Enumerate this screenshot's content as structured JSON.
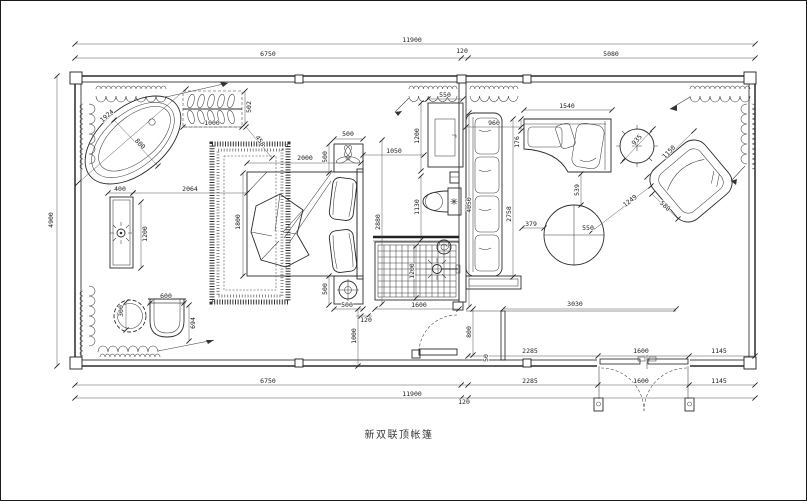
{
  "title": "新双联顶帐篷",
  "colors": {
    "ink": "#1c1c1c",
    "background": "#ffffff"
  },
  "plan": {
    "dim_labels": [
      {
        "t": "11900",
        "x": 412,
        "y": 40
      },
      {
        "t": "6750",
        "x": 268,
        "y": 54
      },
      {
        "t": "120",
        "x": 462,
        "y": 51
      },
      {
        "t": "5080",
        "x": 611,
        "y": 54
      },
      {
        "t": "4900",
        "x": 51,
        "y": 220,
        "r": -90
      },
      {
        "t": "2285",
        "x": 530,
        "y": 351
      },
      {
        "t": "1600",
        "x": 641,
        "y": 351
      },
      {
        "t": "1145",
        "x": 719,
        "y": 351
      },
      {
        "t": "6750",
        "x": 268,
        "y": 381
      },
      {
        "t": "2285",
        "x": 530,
        "y": 381
      },
      {
        "t": "1600",
        "x": 641,
        "y": 381
      },
      {
        "t": "1145",
        "x": 719,
        "y": 381
      },
      {
        "t": "11900",
        "x": 412,
        "y": 394
      },
      {
        "t": "120",
        "x": 464,
        "y": 402
      },
      {
        "t": "1924",
        "x": 107,
        "y": 116,
        "r": -41
      },
      {
        "t": "800",
        "x": 140,
        "y": 144,
        "r": 46
      },
      {
        "t": "1000",
        "x": 212,
        "y": 123
      },
      {
        "t": "502",
        "x": 249,
        "y": 107,
        "r": -90
      },
      {
        "t": "458",
        "x": 260,
        "y": 141,
        "r": 55
      },
      {
        "t": "400",
        "x": 120,
        "y": 189
      },
      {
        "t": "2064",
        "x": 190,
        "y": 189
      },
      {
        "t": "1200",
        "x": 145,
        "y": 234,
        "r": -90
      },
      {
        "t": "300",
        "x": 121,
        "y": 311,
        "r": -90
      },
      {
        "t": "600",
        "x": 166,
        "y": 296
      },
      {
        "t": "694",
        "x": 193,
        "y": 323,
        "r": -90
      },
      {
        "t": "2000",
        "x": 305,
        "y": 158
      },
      {
        "t": "500",
        "x": 348,
        "y": 134
      },
      {
        "t": "500",
        "x": 325,
        "y": 157,
        "r": -90
      },
      {
        "t": "1800",
        "x": 238,
        "y": 222,
        "r": -90
      },
      {
        "t": "500",
        "x": 325,
        "y": 289,
        "r": -90
      },
      {
        "t": "500",
        "x": 347,
        "y": 305
      },
      {
        "t": "120",
        "x": 366,
        "y": 320
      },
      {
        "t": "1000",
        "x": 354,
        "y": 336,
        "r": -90
      },
      {
        "t": "1050",
        "x": 394,
        "y": 151
      },
      {
        "t": "2880",
        "x": 378,
        "y": 222,
        "r": -90
      },
      {
        "t": "550",
        "x": 445,
        "y": 95
      },
      {
        "t": "1200",
        "x": 417,
        "y": 136,
        "r": -90
      },
      {
        "t": "1130",
        "x": 417,
        "y": 207,
        "r": -90
      },
      {
        "t": "1200",
        "x": 412,
        "y": 271,
        "r": -90
      },
      {
        "t": "1600",
        "x": 419,
        "y": 305
      },
      {
        "t": "800",
        "x": 469,
        "y": 332,
        "r": -90
      },
      {
        "t": "50",
        "x": 486,
        "y": 358,
        "r": -90
      },
      {
        "t": "4050",
        "x": 469,
        "y": 205,
        "r": -90
      },
      {
        "t": "960",
        "x": 494,
        "y": 123
      },
      {
        "t": "176",
        "x": 517,
        "y": 142,
        "r": -90
      },
      {
        "t": "1540",
        "x": 567,
        "y": 106
      },
      {
        "t": "2758",
        "x": 509,
        "y": 214,
        "r": -90
      },
      {
        "t": "539",
        "x": 577,
        "y": 190,
        "r": -90
      },
      {
        "t": "379",
        "x": 531,
        "y": 224
      },
      {
        "t": "550",
        "x": 588,
        "y": 228
      },
      {
        "t": "935",
        "x": 637,
        "y": 140,
        "r": -48
      },
      {
        "t": "1150",
        "x": 669,
        "y": 152,
        "r": -46
      },
      {
        "t": "1249",
        "x": 630,
        "y": 201,
        "r": -37
      },
      {
        "t": "580",
        "x": 665,
        "y": 206,
        "r": 44
      },
      {
        "t": "3030",
        "x": 575,
        "y": 304
      }
    ],
    "dim_lines": [
      {
        "x1": 75,
        "y1": 44,
        "x2": 755,
        "y2": 44
      },
      {
        "x1": 75,
        "y1": 58,
        "x2": 755,
        "y2": 58,
        "k": [
          0,
          0.568,
          0.578,
          1
        ]
      },
      {
        "x1": 57,
        "y1": 76,
        "x2": 57,
        "y2": 366
      },
      {
        "x1": 75,
        "y1": 385,
        "x2": 755,
        "y2": 385,
        "k": [
          0,
          0.568,
          0.578,
          0.769,
          0.903,
          1
        ]
      },
      {
        "x1": 75,
        "y1": 398,
        "x2": 755,
        "y2": 398,
        "k": [
          0,
          0.568,
          0.578,
          1
        ]
      },
      {
        "x1": 468,
        "y1": 356,
        "x2": 755,
        "y2": 356,
        "k": [
          0,
          0.453,
          0.77,
          1
        ]
      },
      {
        "x1": 183,
        "y1": 127,
        "x2": 242,
        "y2": 127
      },
      {
        "x1": 245,
        "y1": 91,
        "x2": 245,
        "y2": 124
      },
      {
        "x1": 108,
        "y1": 193,
        "x2": 133,
        "y2": 193
      },
      {
        "x1": 133,
        "y1": 193,
        "x2": 247,
        "y2": 193
      },
      {
        "x1": 141,
        "y1": 202,
        "x2": 141,
        "y2": 268
      },
      {
        "x1": 126,
        "y1": 302,
        "x2": 126,
        "y2": 330
      },
      {
        "x1": 150,
        "y1": 303,
        "x2": 184,
        "y2": 303
      },
      {
        "x1": 189,
        "y1": 305,
        "x2": 189,
        "y2": 341
      },
      {
        "x1": 247,
        "y1": 163,
        "x2": 361,
        "y2": 163
      },
      {
        "x1": 334,
        "y1": 139,
        "x2": 363,
        "y2": 139
      },
      {
        "x1": 329,
        "y1": 144,
        "x2": 329,
        "y2": 173
      },
      {
        "x1": 243,
        "y1": 173,
        "x2": 243,
        "y2": 276
      },
      {
        "x1": 329,
        "y1": 276,
        "x2": 329,
        "y2": 305
      },
      {
        "x1": 334,
        "y1": 309,
        "x2": 363,
        "y2": 309
      },
      {
        "x1": 356,
        "y1": 316,
        "x2": 372,
        "y2": 316,
        "k": [
          0.31,
          0.75
        ]
      },
      {
        "x1": 358,
        "y1": 309,
        "x2": 358,
        "y2": 366
      },
      {
        "x1": 363,
        "y1": 155,
        "x2": 424,
        "y2": 155
      },
      {
        "x1": 382,
        "y1": 140,
        "x2": 382,
        "y2": 304
      },
      {
        "x1": 428,
        "y1": 99,
        "x2": 463,
        "y2": 99
      },
      {
        "x1": 421,
        "y1": 103,
        "x2": 421,
        "y2": 171
      },
      {
        "x1": 421,
        "y1": 176,
        "x2": 421,
        "y2": 240
      },
      {
        "x1": 416,
        "y1": 246,
        "x2": 416,
        "y2": 298
      },
      {
        "x1": 375,
        "y1": 309,
        "x2": 459,
        "y2": 309
      },
      {
        "x1": 473,
        "y1": 309,
        "x2": 473,
        "y2": 355
      },
      {
        "x1": 469,
        "y1": 113,
        "x2": 469,
        "y2": 307
      },
      {
        "x1": 466,
        "y1": 127,
        "x2": 521,
        "y2": 127
      },
      {
        "x1": 521,
        "y1": 119,
        "x2": 521,
        "y2": 131
      },
      {
        "x1": 524,
        "y1": 110,
        "x2": 612,
        "y2": 110
      },
      {
        "x1": 513,
        "y1": 119,
        "x2": 513,
        "y2": 277
      },
      {
        "x1": 581,
        "y1": 174,
        "x2": 581,
        "y2": 205
      },
      {
        "x1": 522,
        "y1": 228,
        "x2": 544,
        "y2": 228
      },
      {
        "x1": 503,
        "y1": 309,
        "x2": 676,
        "y2": 309
      },
      {
        "x1": 623,
        "y1": 161,
        "x2": 653,
        "y2": 129
      },
      {
        "x1": 647,
        "y1": 177,
        "x2": 694,
        "y2": 131
      },
      {
        "x1": 592,
        "y1": 231,
        "x2": 651,
        "y2": 186
      },
      {
        "x1": 652,
        "y1": 194,
        "x2": 678,
        "y2": 219
      },
      {
        "x1": 78,
        "y1": 183,
        "x2": 186,
        "y2": 89
      },
      {
        "x1": 114,
        "y1": 120,
        "x2": 158,
        "y2": 166
      },
      {
        "x1": 246,
        "y1": 127,
        "x2": 272,
        "y2": 158
      }
    ]
  }
}
